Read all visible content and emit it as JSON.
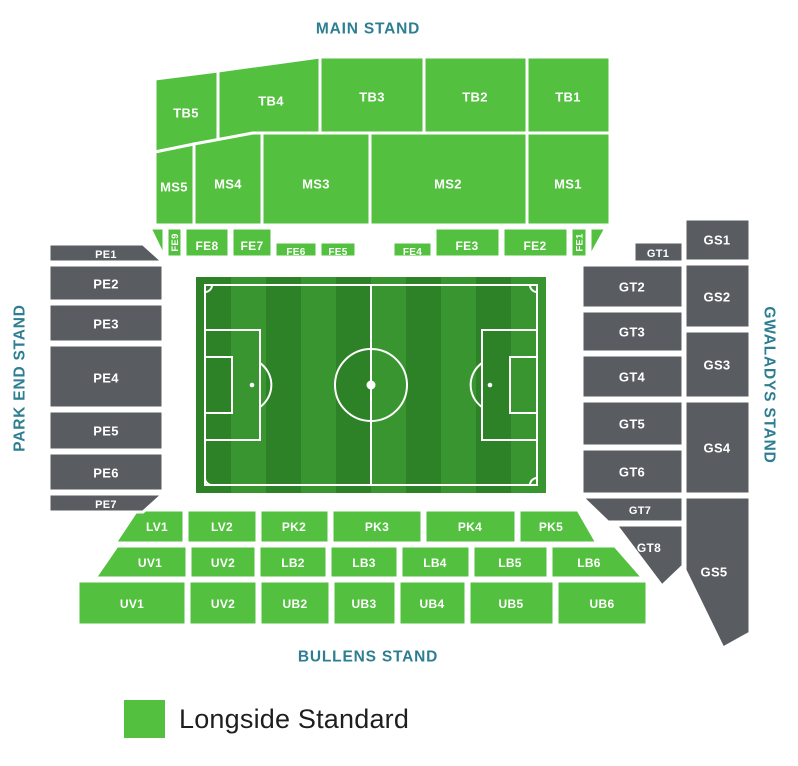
{
  "colors": {
    "available": "#53c13f",
    "unavailable": "#595d62",
    "stand_title": "#2d7e90",
    "section_label": "#ffffff",
    "legend_text": "#1e1e1e",
    "pitch_dark": "#2d8127",
    "pitch_light": "#38952f",
    "pitch_line": "#ffffff"
  },
  "stand_titles": [
    {
      "id": "main-stand",
      "label": "MAIN STAND",
      "x": 368,
      "y": 28,
      "rotate": 0
    },
    {
      "id": "park-end-stand",
      "label": "PARK END STAND",
      "x": 19,
      "y": 378,
      "rotate": -90
    },
    {
      "id": "gwaladys-stand",
      "label": "GWALADYS STAND",
      "x": 770,
      "y": 385,
      "rotate": 90
    },
    {
      "id": "bullens-stand",
      "label": "BULLENS STAND",
      "x": 368,
      "y": 656,
      "rotate": 0
    }
  ],
  "legend": {
    "items": [
      {
        "label": "Longside Standard",
        "color_key": "available"
      }
    ]
  },
  "sections": [
    {
      "id": "TB5",
      "label": "TB5",
      "status": "available",
      "pts": [
        [
          155,
          79
        ],
        [
          218,
          71
        ],
        [
          218,
          140
        ],
        [
          155,
          152
        ]
      ],
      "lx": 186,
      "ly": 113,
      "fs": 13
    },
    {
      "id": "TB4",
      "label": "TB4",
      "status": "available",
      "pts": [
        [
          218,
          71
        ],
        [
          320,
          57
        ],
        [
          320,
          133
        ],
        [
          253,
          133
        ],
        [
          218,
          140
        ]
      ],
      "lx": 271,
      "ly": 101,
      "fs": 13
    },
    {
      "id": "TB3",
      "label": "TB3",
      "status": "available",
      "rect": [
        320,
        57,
        104,
        76
      ],
      "lx": 372,
      "ly": 97,
      "fs": 13
    },
    {
      "id": "TB2",
      "label": "TB2",
      "status": "available",
      "rect": [
        424,
        57,
        103,
        76
      ],
      "lx": 475,
      "ly": 97,
      "fs": 13
    },
    {
      "id": "TB1",
      "label": "TB1",
      "status": "available",
      "rect": [
        527,
        57,
        83,
        76
      ],
      "lx": 568,
      "ly": 97,
      "fs": 13
    },
    {
      "id": "MS5",
      "label": "MS5",
      "status": "available",
      "pts": [
        [
          155,
          152
        ],
        [
          194,
          144
        ],
        [
          194,
          225
        ],
        [
          155,
          225
        ]
      ],
      "lx": 174,
      "ly": 187,
      "fs": 13
    },
    {
      "id": "MS4",
      "label": "MS4",
      "status": "available",
      "pts": [
        [
          194,
          144
        ],
        [
          253,
          133
        ],
        [
          262,
          133
        ],
        [
          262,
          225
        ],
        [
          194,
          225
        ]
      ],
      "lx": 228,
      "ly": 184,
      "fs": 13
    },
    {
      "id": "MS3",
      "label": "MS3",
      "status": "available",
      "rect": [
        262,
        133,
        108,
        92
      ],
      "lx": 316,
      "ly": 184,
      "fs": 13
    },
    {
      "id": "MS2",
      "label": "MS2",
      "status": "available",
      "rect": [
        370,
        133,
        157,
        92
      ],
      "lx": 448,
      "ly": 184,
      "fs": 13
    },
    {
      "id": "MS1",
      "label": "MS1",
      "status": "available",
      "rect": [
        527,
        133,
        83,
        92
      ],
      "lx": 568,
      "ly": 184,
      "fs": 13
    },
    {
      "id": "FE-corner-left",
      "label": "",
      "status": "available",
      "pts": [
        [
          150,
          228
        ],
        [
          164,
          228
        ],
        [
          164,
          257
        ]
      ],
      "lx": 0,
      "ly": 0,
      "fs": 0
    },
    {
      "id": "FE9",
      "label": "FE9",
      "status": "available",
      "rect": [
        167,
        228,
        15,
        29
      ],
      "lx": 174.5,
      "ly": 242.5,
      "fs": 9.5,
      "lrot": -90
    },
    {
      "id": "FE8",
      "label": "FE8",
      "status": "available",
      "rect": [
        185,
        228,
        44,
        29
      ],
      "lx": 207,
      "ly": 246,
      "fs": 12
    },
    {
      "id": "FE7",
      "label": "FE7",
      "status": "available",
      "rect": [
        232,
        228,
        40,
        29
      ],
      "lx": 252,
      "ly": 246,
      "fs": 12
    },
    {
      "id": "FE6",
      "label": "FE6",
      "status": "available",
      "rect": [
        275,
        242,
        42,
        15
      ],
      "lx": 296,
      "ly": 251.5,
      "fs": 10
    },
    {
      "id": "FE5",
      "label": "FE5",
      "status": "available",
      "rect": [
        320,
        242,
        36,
        15
      ],
      "lx": 338,
      "ly": 251.5,
      "fs": 10
    },
    {
      "id": "FE4",
      "label": "FE4",
      "status": "available",
      "rect": [
        393,
        242,
        39,
        15
      ],
      "lx": 412.5,
      "ly": 251.5,
      "fs": 10
    },
    {
      "id": "FE3",
      "label": "FE3",
      "status": "available",
      "rect": [
        435,
        228,
        65,
        29
      ],
      "lx": 467,
      "ly": 246,
      "fs": 12
    },
    {
      "id": "FE2",
      "label": "FE2",
      "status": "available",
      "rect": [
        503,
        228,
        65,
        29
      ],
      "lx": 535,
      "ly": 246,
      "fs": 12
    },
    {
      "id": "FE1",
      "label": "FE1",
      "status": "available",
      "rect": [
        571,
        228,
        16,
        29
      ],
      "lx": 579,
      "ly": 242.5,
      "fs": 9.5,
      "lrot": -90
    },
    {
      "id": "FE-corner-right",
      "label": "",
      "status": "available",
      "pts": [
        [
          590,
          228
        ],
        [
          606,
          228
        ],
        [
          590,
          257
        ]
      ],
      "lx": 0,
      "ly": 0,
      "fs": 0
    },
    {
      "id": "LV1",
      "label": "LV1",
      "status": "available",
      "pts": [
        [
          137,
          510
        ],
        [
          184,
          510
        ],
        [
          184,
          543
        ],
        [
          115,
          543
        ]
      ],
      "lx": 157,
      "ly": 527,
      "fs": 12
    },
    {
      "id": "LV2",
      "label": "LV2",
      "status": "available",
      "rect": [
        187,
        510,
        70,
        33
      ],
      "lx": 222,
      "ly": 527,
      "fs": 12
    },
    {
      "id": "PK2",
      "label": "PK2",
      "status": "available",
      "rect": [
        260,
        510,
        69,
        33
      ],
      "lx": 294,
      "ly": 527,
      "fs": 12
    },
    {
      "id": "PK3",
      "label": "PK3",
      "status": "available",
      "rect": [
        332,
        510,
        90,
        33
      ],
      "lx": 377,
      "ly": 527,
      "fs": 12
    },
    {
      "id": "PK4",
      "label": "PK4",
      "status": "available",
      "rect": [
        425,
        510,
        91,
        33
      ],
      "lx": 470,
      "ly": 527,
      "fs": 12
    },
    {
      "id": "PK5",
      "label": "PK5",
      "status": "available",
      "pts": [
        [
          519,
          510
        ],
        [
          578,
          510
        ],
        [
          597,
          543
        ],
        [
          519,
          543
        ]
      ],
      "lx": 551,
      "ly": 527,
      "fs": 12
    },
    {
      "id": "UV1-upper",
      "label": "UV1",
      "status": "available",
      "pts": [
        [
          117,
          546
        ],
        [
          187,
          546
        ],
        [
          187,
          578
        ],
        [
          95,
          578
        ]
      ],
      "lx": 150,
      "ly": 563,
      "fs": 12
    },
    {
      "id": "UV2-upper",
      "label": "UV2",
      "status": "available",
      "rect": [
        190,
        546,
        66,
        32
      ],
      "lx": 223,
      "ly": 563,
      "fs": 12
    },
    {
      "id": "LB2",
      "label": "LB2",
      "status": "available",
      "rect": [
        259,
        546,
        68,
        32
      ],
      "lx": 293,
      "ly": 563,
      "fs": 12
    },
    {
      "id": "LB3",
      "label": "LB3",
      "status": "available",
      "rect": [
        330,
        546,
        68,
        32
      ],
      "lx": 364,
      "ly": 563,
      "fs": 12
    },
    {
      "id": "LB4",
      "label": "LB4",
      "status": "available",
      "rect": [
        401,
        546,
        69,
        32
      ],
      "lx": 435,
      "ly": 563,
      "fs": 12
    },
    {
      "id": "LB5",
      "label": "LB5",
      "status": "available",
      "rect": [
        473,
        546,
        75,
        32
      ],
      "lx": 510,
      "ly": 563,
      "fs": 12
    },
    {
      "id": "LB6",
      "label": "LB6",
      "status": "available",
      "pts": [
        [
          551,
          546
        ],
        [
          615,
          546
        ],
        [
          643,
          578
        ],
        [
          551,
          578
        ]
      ],
      "lx": 589,
      "ly": 563,
      "fs": 12
    },
    {
      "id": "UV1-lower",
      "label": "UV1",
      "status": "available",
      "rect": [
        78,
        581,
        108,
        44
      ],
      "lx": 132,
      "ly": 604,
      "fs": 12
    },
    {
      "id": "UV2-lower",
      "label": "UV2",
      "status": "available",
      "rect": [
        189,
        581,
        68,
        44
      ],
      "lx": 223,
      "ly": 604,
      "fs": 12
    },
    {
      "id": "UB2",
      "label": "UB2",
      "status": "available",
      "rect": [
        260,
        581,
        70,
        44
      ],
      "lx": 295,
      "ly": 604,
      "fs": 12
    },
    {
      "id": "UB3",
      "label": "UB3",
      "status": "available",
      "rect": [
        333,
        581,
        63,
        44
      ],
      "lx": 364,
      "ly": 604,
      "fs": 12
    },
    {
      "id": "UB4",
      "label": "UB4",
      "status": "available",
      "rect": [
        399,
        581,
        67,
        44
      ],
      "lx": 432,
      "ly": 604,
      "fs": 12
    },
    {
      "id": "UB5",
      "label": "UB5",
      "status": "available",
      "rect": [
        469,
        581,
        85,
        44
      ],
      "lx": 511,
      "ly": 604,
      "fs": 12
    },
    {
      "id": "UB6",
      "label": "UB6",
      "status": "available",
      "rect": [
        557,
        581,
        90,
        44
      ],
      "lx": 602,
      "ly": 604,
      "fs": 12
    },
    {
      "id": "PE1",
      "label": "PE1",
      "status": "unavailable",
      "pts": [
        [
          49,
          244
        ],
        [
          143,
          244
        ],
        [
          163,
          262
        ],
        [
          49,
          262
        ]
      ],
      "lx": 106,
      "ly": 254,
      "fs": 11
    },
    {
      "id": "PE2",
      "label": "PE2",
      "status": "unavailable",
      "rect": [
        49,
        265,
        114,
        36
      ],
      "lx": 106,
      "ly": 284,
      "fs": 13
    },
    {
      "id": "PE3",
      "label": "PE3",
      "status": "unavailable",
      "rect": [
        49,
        304,
        114,
        38
      ],
      "lx": 106,
      "ly": 324,
      "fs": 13
    },
    {
      "id": "PE4",
      "label": "PE4",
      "status": "unavailable",
      "rect": [
        49,
        345,
        114,
        63
      ],
      "lx": 106,
      "ly": 378,
      "fs": 13
    },
    {
      "id": "PE5",
      "label": "PE5",
      "status": "unavailable",
      "rect": [
        49,
        411,
        114,
        39
      ],
      "lx": 106,
      "ly": 431,
      "fs": 13
    },
    {
      "id": "PE6",
      "label": "PE6",
      "status": "unavailable",
      "rect": [
        49,
        453,
        114,
        38
      ],
      "lx": 106,
      "ly": 473,
      "fs": 13
    },
    {
      "id": "PE7",
      "label": "PE7",
      "status": "unavailable",
      "pts": [
        [
          49,
          494
        ],
        [
          163,
          494
        ],
        [
          143,
          512
        ],
        [
          49,
          512
        ]
      ],
      "lx": 106,
      "ly": 504,
      "fs": 11
    },
    {
      "id": "GT1",
      "label": "GT1",
      "status": "unavailable",
      "rect": [
        634,
        242,
        49,
        20
      ],
      "lx": 658,
      "ly": 253,
      "fs": 11
    },
    {
      "id": "GT2",
      "label": "GT2",
      "status": "unavailable",
      "rect": [
        582,
        265,
        101,
        43
      ],
      "lx": 632,
      "ly": 287,
      "fs": 13
    },
    {
      "id": "GT3",
      "label": "GT3",
      "status": "unavailable",
      "rect": [
        582,
        311,
        101,
        41
      ],
      "lx": 632,
      "ly": 332,
      "fs": 13
    },
    {
      "id": "GT4",
      "label": "GT4",
      "status": "unavailable",
      "rect": [
        582,
        355,
        101,
        43
      ],
      "lx": 632,
      "ly": 377,
      "fs": 13
    },
    {
      "id": "GT5",
      "label": "GT5",
      "status": "unavailable",
      "rect": [
        582,
        401,
        101,
        45
      ],
      "lx": 632,
      "ly": 424,
      "fs": 13
    },
    {
      "id": "GT6",
      "label": "GT6",
      "status": "unavailable",
      "rect": [
        582,
        449,
        101,
        45
      ],
      "lx": 632,
      "ly": 472,
      "fs": 13
    },
    {
      "id": "GT7",
      "label": "GT7",
      "status": "unavailable",
      "pts": [
        [
          582,
          497
        ],
        [
          683,
          497
        ],
        [
          683,
          522
        ],
        [
          608,
          522
        ]
      ],
      "lx": 640,
      "ly": 510,
      "fs": 11
    },
    {
      "id": "GT8",
      "label": "GT8",
      "status": "unavailable",
      "pts": [
        [
          616,
          525
        ],
        [
          683,
          525
        ],
        [
          683,
          566
        ],
        [
          662,
          586
        ]
      ],
      "lx": 649,
      "ly": 548,
      "fs": 12
    },
    {
      "id": "GS1",
      "label": "GS1",
      "status": "unavailable",
      "rect": [
        685,
        219,
        65,
        42
      ],
      "lx": 717,
      "ly": 240,
      "fs": 13
    },
    {
      "id": "GS2",
      "label": "GS2",
      "status": "unavailable",
      "rect": [
        685,
        264,
        65,
        64
      ],
      "lx": 717,
      "ly": 297,
      "fs": 13
    },
    {
      "id": "GS3",
      "label": "GS3",
      "status": "unavailable",
      "rect": [
        685,
        331,
        65,
        67
      ],
      "lx": 717,
      "ly": 365,
      "fs": 13
    },
    {
      "id": "GS4",
      "label": "GS4",
      "status": "unavailable",
      "rect": [
        685,
        401,
        65,
        93
      ],
      "lx": 717,
      "ly": 448,
      "fs": 13
    },
    {
      "id": "GS5",
      "label": "GS5",
      "status": "unavailable",
      "pts": [
        [
          685,
          497
        ],
        [
          750,
          497
        ],
        [
          750,
          633
        ],
        [
          723,
          648
        ],
        [
          685,
          570
        ]
      ],
      "lx": 714,
      "ly": 572,
      "fs": 13
    }
  ]
}
